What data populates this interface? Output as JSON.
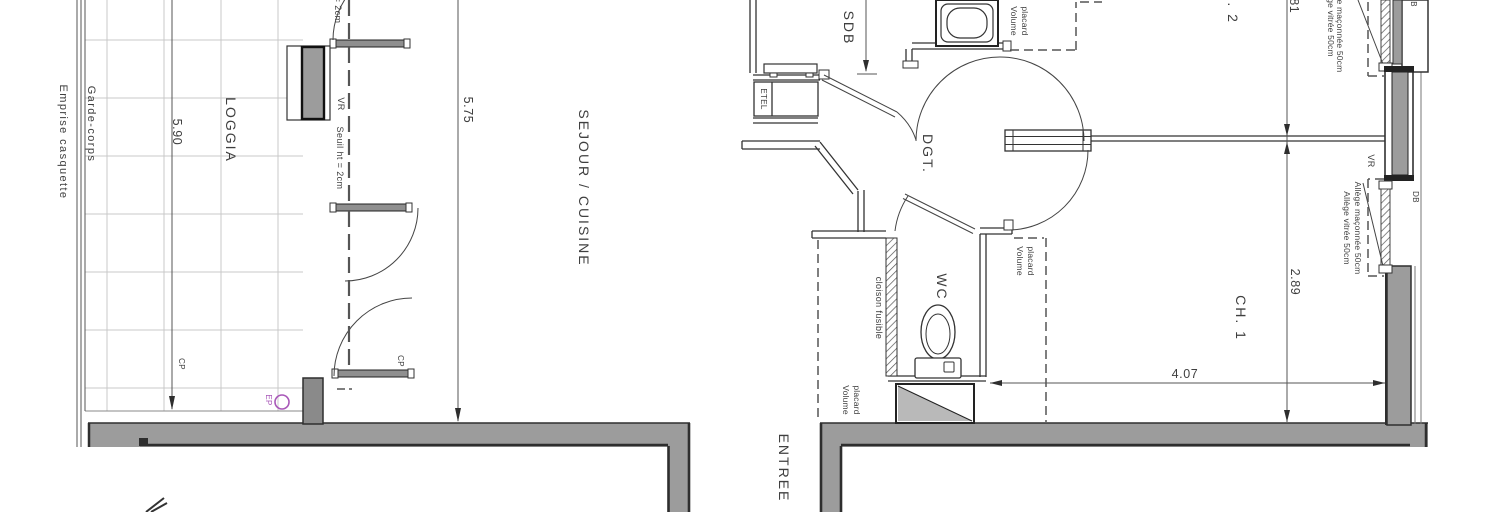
{
  "plan": {
    "rooms": {
      "loggia": "LOGGIA",
      "sejour": "SEJOUR / CUISINE",
      "sdb": "SDB",
      "dgt": "DGT.",
      "wc": "WC",
      "ch1": "CH. 1",
      "ch2": "CH. 2",
      "entree": "ENTREE"
    },
    "dims": {
      "d590": "5.90",
      "d575": "5.75",
      "d281": "2.81",
      "d289": "2.89",
      "d407": "4.07"
    },
    "ann": {
      "emprise": "Emprise casquette",
      "garde": "Garde-corps",
      "seuil": "Seuil ht = 2cm",
      "vr": "VR",
      "db": "DB",
      "cp": "CP",
      "ep": "EP",
      "etel": "ETEL",
      "cloison": "cloison fusible",
      "volume": "Volume",
      "placard": "placard",
      "allege1": "Allège vitrée 50cm",
      "allege2": "Allège maçonnée 50cm"
    },
    "colors": {
      "wall_grey": "#9c9c9c",
      "stub_grey": "#8a8a8a",
      "sill_grey": "#8f8f8f",
      "line_dark": "#2e2e2e",
      "line_mid": "#4a4a4a",
      "grid_grey": "#c9c9c9",
      "ep_purple": "#a857b8"
    }
  }
}
